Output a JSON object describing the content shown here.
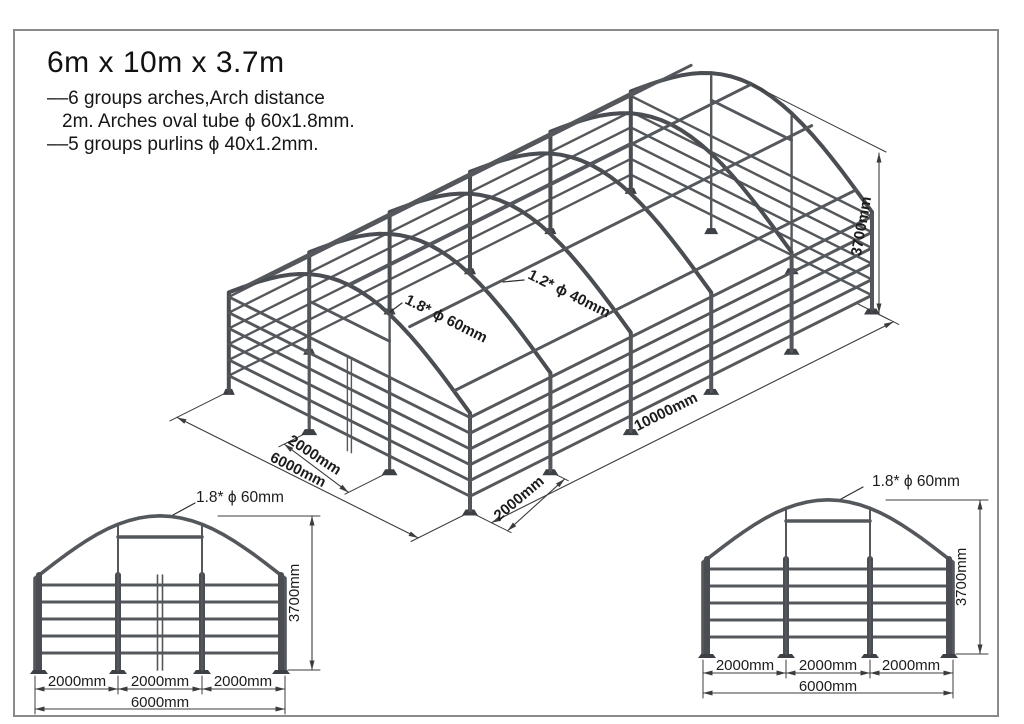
{
  "title": "6m x 10m x 3.7m",
  "notes": {
    "line1": "––6 groups arches,Arch distance",
    "line2": "2m. Arches oval tube ϕ 60x1.8mm.",
    "line3": "––5 groups purlins ϕ 40x1.2mm."
  },
  "iso": {
    "arch_label": "1.8* ϕ 60mm",
    "purlin_label": "1.2* ϕ 40mm",
    "dim_width_bay": "2000mm",
    "dim_width_total": "6000mm",
    "dim_length_bay": "2000mm",
    "dim_length_total": "10000mm",
    "dim_height": "3700mm"
  },
  "front_view": {
    "tube_label": "1.8* ϕ 60mm",
    "dim_height": "3700mm",
    "dim_bays": [
      "2000mm",
      "2000mm",
      "2000mm"
    ],
    "dim_total": "6000mm"
  },
  "rear_view": {
    "tube_label": "1.8* ϕ 60mm",
    "dim_height": "3700mm",
    "dim_bays": [
      "2000mm",
      "2000mm",
      "2000mm"
    ],
    "dim_total": "6000mm"
  },
  "structure": {
    "arch_count": 6,
    "arch_spacing_mm": 2000,
    "purlin_count": 5,
    "width_mm": 6000,
    "length_mm": 10000,
    "height_mm": 3700
  },
  "colors": {
    "line": "#2e2e2e",
    "tube": "#54585c",
    "tube_dark": "#4a4e52",
    "plate": "#3d4145",
    "dim": "#3c3c3c",
    "border": "#8a8a8a",
    "background": "#ffffff"
  }
}
